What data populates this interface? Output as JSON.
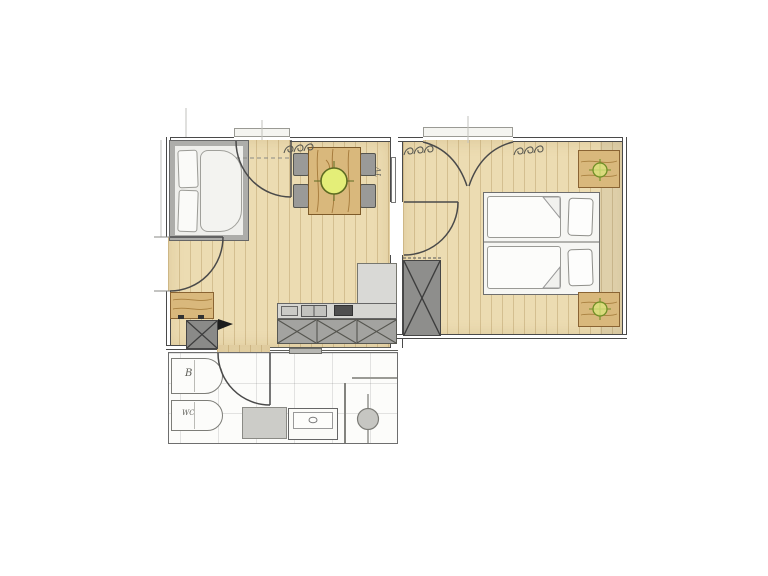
{
  "labels": {
    "tv": "TV",
    "bidet": "B",
    "toilet": "WC"
  },
  "colors": {
    "paper": "#ffffff",
    "wood_floor": "#ecdcb2",
    "furniture_wood": "#d9b87c",
    "wall_line": "#4a4a4a",
    "fixture_gray": "#9a9a98",
    "pendant_lamp_fill": "#e4ee78",
    "pendant_lamp_outline": "#5d6b22",
    "bed_lamp_green": "#6f8f26"
  },
  "icons": [
    {
      "name": "pendant-light-icon",
      "shape": "circle-with-cross",
      "color": "#e4ee78"
    },
    {
      "name": "bed-lamp-icon",
      "shape": "small-circle-with-cross",
      "color": "#6f8f26"
    },
    {
      "name": "door-swing-icon",
      "shape": "quarter-arc"
    },
    {
      "name": "curtain-squiggle-icon",
      "shape": "loop-scribble"
    },
    {
      "name": "wardrobe-x-icon",
      "shape": "crossed-box"
    },
    {
      "name": "cabinet-x-icon",
      "shape": "crossed-box"
    }
  ]
}
